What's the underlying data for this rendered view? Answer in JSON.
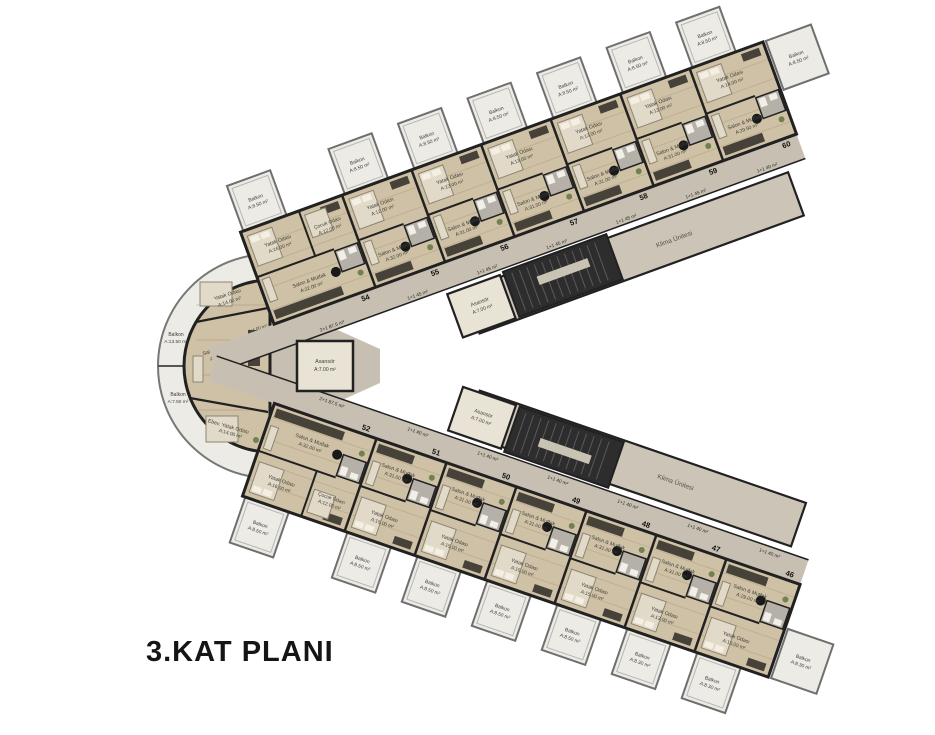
{
  "title": "3.KAT PLANI",
  "colors": {
    "floor": "#cfc1a5",
    "corridor": "#c7c0b2",
    "strip": "#ccc5b7",
    "balcony": "#edebe6",
    "wall": "#212121",
    "stair": "#2d2d2d",
    "furniture_dark": "#46423a",
    "furniture_light": "#e2dac8",
    "bath": "#b5b1a9",
    "plant_green": "#72814f",
    "text": "#3f3e3a"
  },
  "cores": {
    "elevator": {
      "name": "Asansör",
      "area": "A:7.00 m²"
    },
    "hvac_label": "Klima Ünitesi"
  },
  "left_unit": {
    "number": "53",
    "bath_area": "A:4.00 m²",
    "rooms": [
      {
        "name": "Yatak Odası",
        "area": "A:14.00 m²"
      },
      {
        "name": "Salon & Mutfak",
        "area": "A:30.00 m²"
      },
      {
        "name": "Ebev. Yatak Odası",
        "area": "A:14.00 m²"
      }
    ],
    "balconies": [
      {
        "name": "Balkon",
        "area": "A:13.50 m²"
      },
      {
        "name": "Balkon",
        "area": "A:7.50 m²"
      }
    ]
  },
  "upper_wing": {
    "units": [
      {
        "number": "54",
        "type": "2+1 87.5 m²",
        "rooms": [
          {
            "name": "Yatak Odası",
            "area": "A:16.00 m²"
          },
          {
            "name": "Çocuk Odası",
            "area": "A:12.00 m²"
          },
          {
            "name": "Salon & Mutfak",
            "area": "A:32.00 m²"
          }
        ],
        "balcony": {
          "name": "Balkon",
          "area": "A:8.50 m²"
        }
      },
      {
        "number": "55",
        "type": "1+1 45 m²",
        "rooms": [
          {
            "name": "Yatak Odası",
            "area": "A:12.00 m²"
          },
          {
            "name": "Salon & Mutfak",
            "area": "A:32.00 m²"
          }
        ],
        "balcony": {
          "name": "Balkon",
          "area": "A:8.50 m²"
        }
      },
      {
        "number": "56",
        "type": "1+1 45 m²",
        "rooms": [
          {
            "name": "Yatak Odası",
            "area": "A:13.00 m²"
          },
          {
            "name": "Salon & Mutfak",
            "area": "A:31.00 m²"
          }
        ],
        "balcony": {
          "name": "Balkon",
          "area": "A:8.50 m²"
        }
      },
      {
        "number": "57",
        "type": "1+1 45 m²",
        "rooms": [
          {
            "name": "Yatak Odası",
            "area": "A:13.00 m²"
          },
          {
            "name": "Salon & Mutfak",
            "area": "A:31.00 m²"
          }
        ],
        "balcony": {
          "name": "Balkon",
          "area": "A:8.50 m²"
        }
      },
      {
        "number": "58",
        "type": "1+1 45 m²",
        "rooms": [
          {
            "name": "Yatak Odası",
            "area": "A:13.00 m²"
          },
          {
            "name": "Salon & Mutfak",
            "area": "A:31.00 m²"
          }
        ],
        "balcony": {
          "name": "Balkon",
          "area": "A:8.50 m²"
        }
      },
      {
        "number": "59",
        "type": "1+1 45 m²",
        "rooms": [
          {
            "name": "Yatak Odası",
            "area": "A:13.00 m²"
          },
          {
            "name": "Salon & Mutfak",
            "area": "A:31.00 m²"
          }
        ],
        "balcony": {
          "name": "Balkon",
          "area": "A:8.50 m²"
        }
      },
      {
        "number": "60",
        "type": "1+1 40 m²",
        "rooms": [
          {
            "name": "Yatak Odası",
            "area": "A:14.00 m²"
          },
          {
            "name": "Salon & Mutfak",
            "area": "A:29.50 m²"
          }
        ],
        "balcony": {
          "name": "Balkon",
          "area": "A:8.50 m²"
        }
      }
    ]
  },
  "lower_wing": {
    "units": [
      {
        "number": "52",
        "type": "2+1 87.5 m²",
        "rooms": [
          {
            "name": "Yatak Odası",
            "area": "A:16.00 m²"
          },
          {
            "name": "Çocuk Odası",
            "area": "A:12.00 m²"
          },
          {
            "name": "Salon & Mutfak",
            "area": "A:32.00 m²"
          }
        ],
        "balcony": {
          "name": "Balkon",
          "area": "A:8.50 m²"
        }
      },
      {
        "number": "51",
        "type": "1+1 40 m²",
        "rooms": [
          {
            "name": "Yatak Odası",
            "area": "A:15.00 m²"
          },
          {
            "name": "Salon & Mutfak",
            "area": "A:31.00 m²"
          }
        ],
        "balcony": {
          "name": "Balkon",
          "area": "A:8.50 m²"
        }
      },
      {
        "number": "50",
        "type": "1+1 40 m²",
        "rooms": [
          {
            "name": "Yatak Odası",
            "area": "A:15.00 m²"
          },
          {
            "name": "Salon & Mutfak",
            "area": "A:31.00 m²"
          }
        ],
        "balcony": {
          "name": "Balkon",
          "area": "A:8.50 m²"
        }
      },
      {
        "number": "49",
        "type": "1+1 40 m²",
        "rooms": [
          {
            "name": "Yatak Odası",
            "area": "A:15.00 m²"
          },
          {
            "name": "Salon & Mutfak",
            "area": "A:31.00 m²"
          }
        ],
        "balcony": {
          "name": "Balkon",
          "area": "A:8.50 m²"
        }
      },
      {
        "number": "48",
        "type": "1+1 40 m²",
        "rooms": [
          {
            "name": "Yatak Odası",
            "area": "A:15.00 m²"
          },
          {
            "name": "Salon & Mutfak",
            "area": "A:31.00 m²"
          }
        ],
        "balcony": {
          "name": "Balkon",
          "area": "A:8.50 m²"
        }
      },
      {
        "number": "47",
        "type": "1+1 40 m²",
        "rooms": [
          {
            "name": "Yatak Odası",
            "area": "A:13.00 m²"
          },
          {
            "name": "Salon & Mutfak",
            "area": "A:31.00 m²"
          }
        ],
        "balcony": {
          "name": "Balkon",
          "area": "A:8.30 m²"
        }
      },
      {
        "number": "46",
        "type": "1+1 40 m²",
        "rooms": [
          {
            "name": "Yatak Odası",
            "area": "A:13.00 m²"
          },
          {
            "name": "Salon & Mutfak",
            "area": "A:29.00 m²"
          }
        ],
        "balcony": {
          "name": "Balkon",
          "area": "A:8.30 m²"
        }
      }
    ]
  }
}
